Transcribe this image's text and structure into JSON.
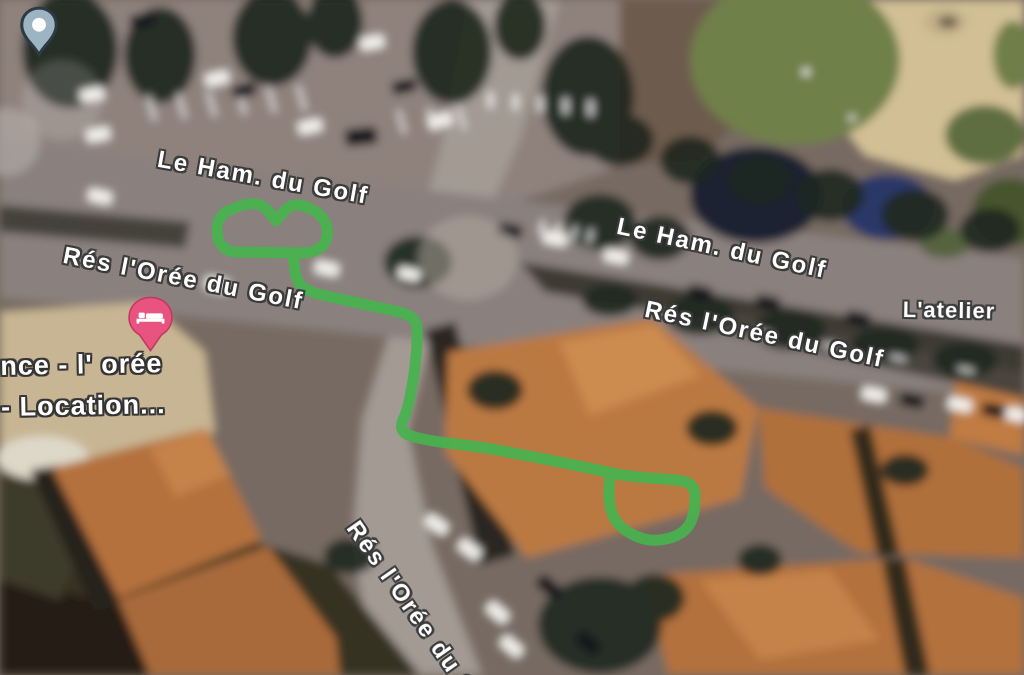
{
  "app": {
    "name": "satellite-map-view",
    "view_type": "satellite"
  },
  "map": {
    "street_labels": [
      {
        "text": "Le Ham. du Golf"
      },
      {
        "text": "Le Ham. du Golf"
      },
      {
        "text": "Rés l'Orée du Golf"
      },
      {
        "text": "Rés l'Orée du Golf"
      },
      {
        "text": "Rés l'Orée du G"
      },
      {
        "text": "L'atelier"
      }
    ],
    "place_label": {
      "line1": "nce - l' orée",
      "line2": "- Location..."
    },
    "route": {
      "color": "#49b14f"
    },
    "pins": {
      "generic": {
        "icon": "map-pin-icon",
        "color": "#9db5c2",
        "outline": "#2c3a44",
        "dot": "#ffffff"
      },
      "lodging": {
        "icon": "bed-icon",
        "color": "#e8537f",
        "glyph_color": "#ffffff"
      }
    }
  }
}
